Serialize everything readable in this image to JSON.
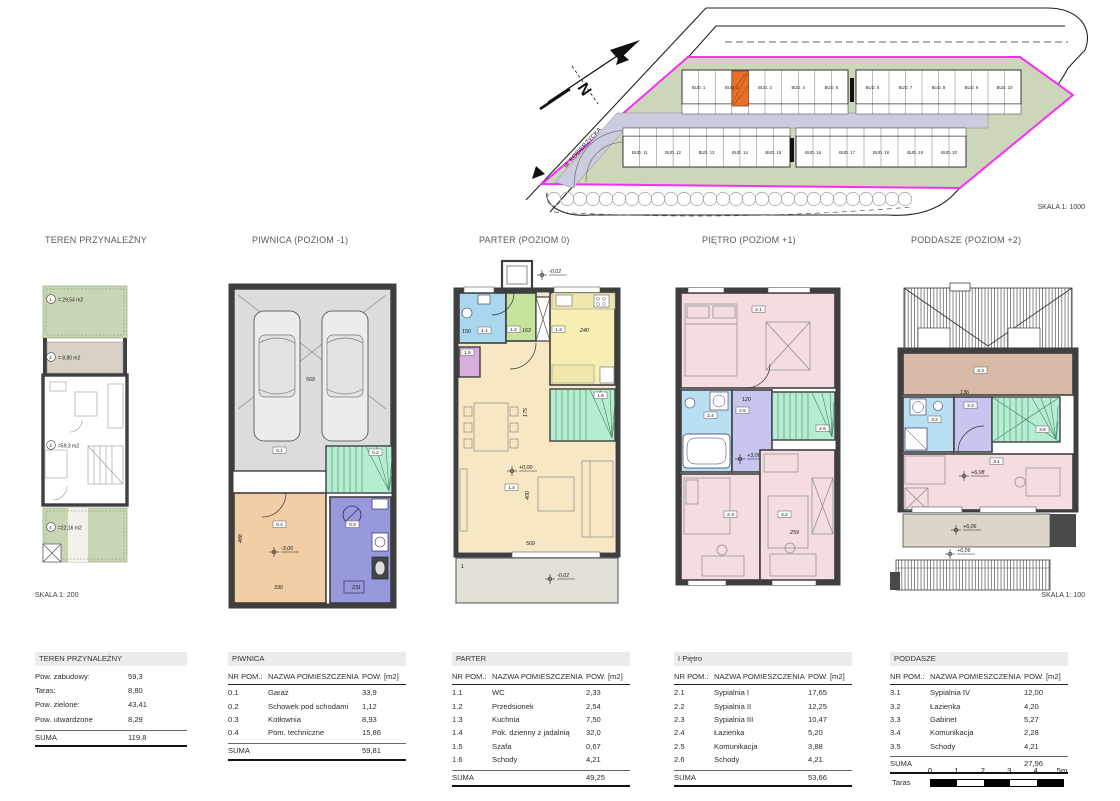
{
  "site_plan": {
    "scale_label": "SKALA 1: 1000",
    "street_label": "ul. KOBIERZYCKA",
    "north_letter": "N",
    "highlight_color": "#e8702a",
    "boundary_color": "#f72ef7",
    "buildings_top": [
      "BUD. 1",
      "BUD. 2",
      "BUD. 3",
      "BUD. 4",
      "BUD. 5",
      "BUD. 6",
      "BUD. 7",
      "BUD. 8",
      "BUD. 9",
      "BUD. 10"
    ],
    "buildings_bottom": [
      "BUD. 11",
      "BUD. 12",
      "BUD. 13",
      "BUD. 14",
      "BUD. 15",
      "BUD. 16",
      "BUD. 17",
      "BUD. 18",
      "BUD. 19",
      "BUD. 20"
    ]
  },
  "column_titles": {
    "teren": "TEREN PRZYNALEŻNY",
    "piwnica": "PIWNICA (POZIOM -1)",
    "parter": "PARTER (POZIOM 0)",
    "pietro": "PIĘTRO (POZIOM +1)",
    "poddasze": "PODDASZE (POZIOM +2)"
  },
  "teren_plan": {
    "scale_label": "SKALA 1: 200",
    "zone1_num": "1.",
    "zone1_area": "= 29,54 m2",
    "zone2_num": "2.",
    "zone2_area": "= 8,80 m2",
    "zone3_num": "3.",
    "zone3_area": "=59,3 m2",
    "zone4_num": "4.",
    "zone4_area": "=22,16 m2"
  },
  "piwnica_plan": {
    "r1": "0.1",
    "r2": "0.2",
    "r3": "0.3",
    "r4": "0.4",
    "level": "-3,06",
    "d569": "569",
    "d488": "488",
    "d330": "330",
    "d231": "231"
  },
  "parter_plan": {
    "r1": "1.1",
    "r2": "1.2",
    "r3": "1.3",
    "r4": "1.4",
    "r5": "1.5",
    "r6": "1.6",
    "level_entry": "-0,02",
    "level_floor": "+0,00",
    "level_terrace": "-0,02",
    "d150": "150",
    "d163": "163",
    "d240": "240",
    "d175": "175",
    "d400": "400",
    "d569": "569",
    "terrace_mark": "1"
  },
  "pietro_plan": {
    "r1": "2.1",
    "r2": "2.2",
    "r3": "2.3",
    "r4": "2.4",
    "r5": "2.5",
    "r6": "2.6",
    "level": "+3,06",
    "d120": "120",
    "d259": "259"
  },
  "poddasze_plan": {
    "scale_label": "SKALA 1: 100",
    "r1": "3.1",
    "r2": "3.2",
    "r3": "3.3",
    "r4": "3.4",
    "r5": "3.5",
    "level_floor": "+6,08",
    "level_terrace": "+6,06",
    "level_lower": "+6,06",
    "d136": "136"
  },
  "tables": {
    "teren": {
      "title": "TEREN PRZYNALEŻNY",
      "rows": [
        {
          "label": "Pow. zabudowy:",
          "value": "59,3"
        },
        {
          "label": "Taras:",
          "value": "8,80"
        },
        {
          "label": "Pow. zielone:",
          "value": "43,41"
        },
        {
          "label": "Pow. utwardzone",
          "value": "8,29"
        }
      ],
      "suma_label": "SUMA",
      "suma_value": "119,8"
    },
    "piwnica": {
      "title": "PIWNICA",
      "col_nr": "NR POM.:",
      "col_name": "NAZWA POMIESZCZENIA",
      "col_area": "POW. [m2]",
      "rows": [
        {
          "nr": "0.1",
          "name": "Garaż",
          "area": "33,9"
        },
        {
          "nr": "0.2",
          "name": "Schowek pod schodami",
          "area": "1,12"
        },
        {
          "nr": "0.3",
          "name": "Kotłownia",
          "area": "8,93"
        },
        {
          "nr": "0.4",
          "name": "Pom. techniczne",
          "area": "15,86"
        }
      ],
      "suma_label": "SUMA",
      "suma_value": "59,81"
    },
    "parter": {
      "title": "PARTER",
      "col_nr": "NR POM.:",
      "col_name": "NAZWA POMIESZCZENIA",
      "col_area": "POW. [m2]",
      "rows": [
        {
          "nr": "1.1",
          "name": "WC",
          "area": "2,33"
        },
        {
          "nr": "1.2",
          "name": "Przedsionek",
          "area": "2,54"
        },
        {
          "nr": "1.3",
          "name": "Kuchnia",
          "area": "7,50"
        },
        {
          "nr": "1.4",
          "name": "Pok. dzienny z jadalnią",
          "area": "32,0"
        },
        {
          "nr": "1.5",
          "name": "Szafa",
          "area": "0,67"
        },
        {
          "nr": "1.6",
          "name": "Schody",
          "area": "4,21"
        }
      ],
      "suma_label": "SUMA",
      "suma_value": "49,25"
    },
    "pietro": {
      "title": "I Piętro",
      "col_nr": "NR POM.:",
      "col_name": "NAZWA POMIESZCZENIA",
      "col_area": "POW. [m2]",
      "rows": [
        {
          "nr": "2.1",
          "name": "Sypialnia I",
          "area": "17,65"
        },
        {
          "nr": "2.2",
          "name": "Sypialnia II",
          "area": "12,25"
        },
        {
          "nr": "2.3",
          "name": "Sypialnia III",
          "area": "10,47"
        },
        {
          "nr": "2.4",
          "name": "Łazienka",
          "area": "5,20"
        },
        {
          "nr": "2.5",
          "name": "Komunikacja",
          "area": "3,88"
        },
        {
          "nr": "2.6",
          "name": "Schody",
          "area": "4,21"
        }
      ],
      "suma_label": "SUMA",
      "suma_value": "53,66"
    },
    "poddasze": {
      "title": "PODDASZE",
      "col_nr": "NR POM.:",
      "col_name": "NAZWA POMIESZCZENIA",
      "col_area": "POW. [m2]",
      "rows": [
        {
          "nr": "3.1",
          "name": "Sypialnia IV",
          "area": "12,00"
        },
        {
          "nr": "3.2",
          "name": "Łazienka",
          "area": "4,20"
        },
        {
          "nr": "3.3",
          "name": "Gabinet",
          "area": "5,27"
        },
        {
          "nr": "3.4",
          "name": "Komunikacja",
          "area": "2,28"
        },
        {
          "nr": "3.5",
          "name": "Schody",
          "area": "4,21"
        }
      ],
      "suma_label": "SUMA",
      "suma_value": "27,96",
      "extra_label": "Taras",
      "extra_value": "6,90"
    }
  },
  "scale_bar": {
    "t0": "0",
    "t1": "1",
    "t2": "2",
    "t3": "3",
    "t4": "4",
    "t5": "5m"
  }
}
